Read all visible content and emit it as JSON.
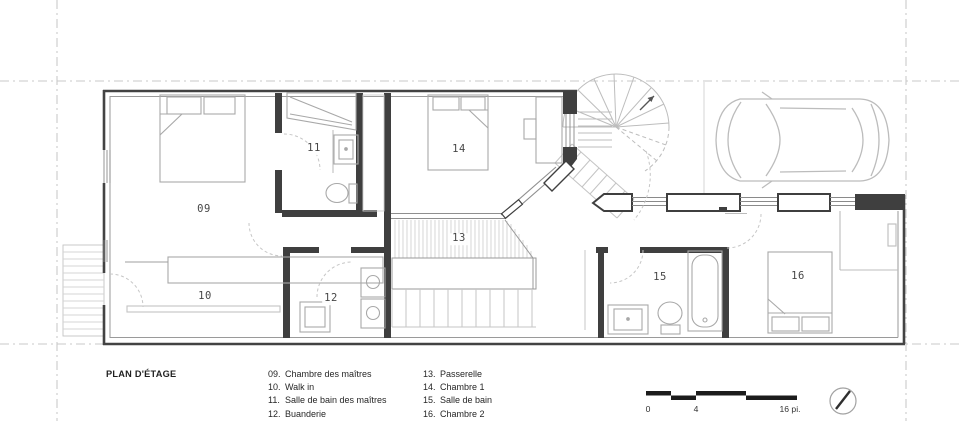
{
  "legend": {
    "title": "PLAN D'ÉTAGE",
    "columns": [
      [
        {
          "num": "09.",
          "label": "Chambre des maîtres"
        },
        {
          "num": "10.",
          "label": "Walk in"
        },
        {
          "num": "11.",
          "label": "Salle de bain des maîtres"
        },
        {
          "num": "12.",
          "label": "Buanderie"
        }
      ],
      [
        {
          "num": "13.",
          "label": "Passerelle"
        },
        {
          "num": "14.",
          "label": "Chambre 1"
        },
        {
          "num": "15.",
          "label": "Salle de bain"
        },
        {
          "num": "16.",
          "label": "Chambre 2"
        }
      ]
    ]
  },
  "plan_labels": [
    {
      "id": "09",
      "text": "09",
      "x": 204,
      "y": 210
    },
    {
      "id": "10",
      "text": "10",
      "x": 205,
      "y": 297
    },
    {
      "id": "11",
      "text": "11",
      "x": 314,
      "y": 149
    },
    {
      "id": "12",
      "text": "12",
      "x": 331,
      "y": 299
    },
    {
      "id": "13",
      "text": "13",
      "x": 459,
      "y": 239
    },
    {
      "id": "14",
      "text": "14",
      "x": 459,
      "y": 150
    },
    {
      "id": "15",
      "text": "15",
      "x": 660,
      "y": 278
    },
    {
      "id": "16",
      "text": "16",
      "x": 798,
      "y": 277
    }
  ],
  "scale": {
    "start": "0",
    "mid": "4",
    "end": "16 pi."
  },
  "colors": {
    "wall": "#3f3f3f",
    "wall_inner": "#9a9a9a",
    "furniture": "#a8a8a8",
    "hatch": "#cdcdcd",
    "dash_line": "#c9c9c9",
    "stair": "#bdbdbd",
    "scale_bar": "#1c1c1c"
  }
}
